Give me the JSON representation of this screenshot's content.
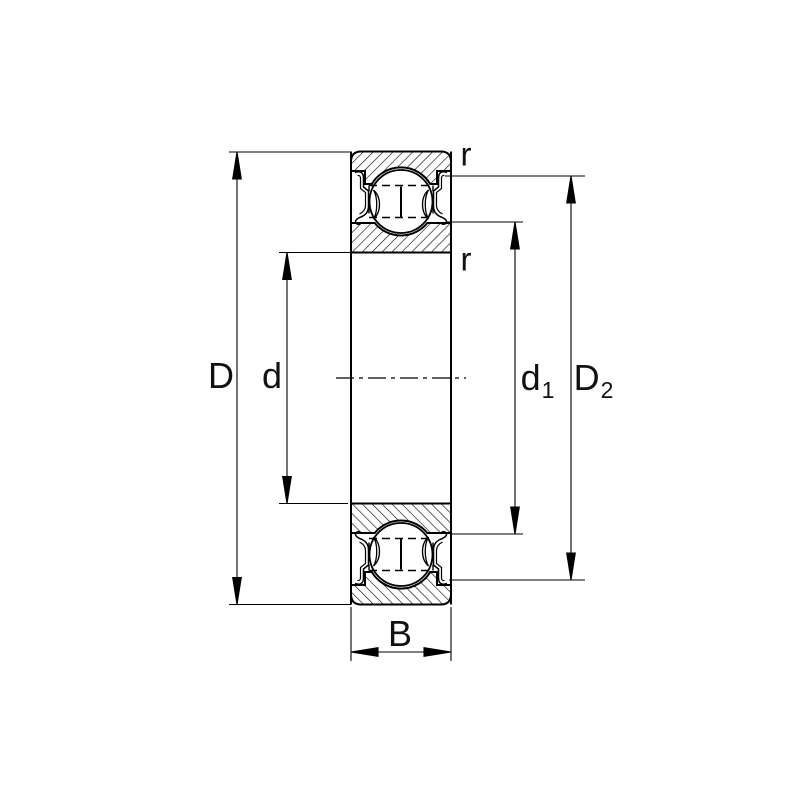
{
  "diagram_type": "bearing-cross-section",
  "colors": {
    "ink": "#000000",
    "background": "#ffffff"
  },
  "labels": {
    "outer_diameter": {
      "main": "D",
      "sub": ""
    },
    "bore_diameter": {
      "main": "d",
      "sub": ""
    },
    "shoulder_diameter": {
      "main": "d",
      "sub": "1"
    },
    "recess_diameter": {
      "main": "D",
      "sub": "2"
    },
    "width": {
      "main": "B",
      "sub": ""
    },
    "radius_outer": {
      "main": "r",
      "sub": ""
    },
    "radius_inner": {
      "main": "r",
      "sub": ""
    }
  }
}
